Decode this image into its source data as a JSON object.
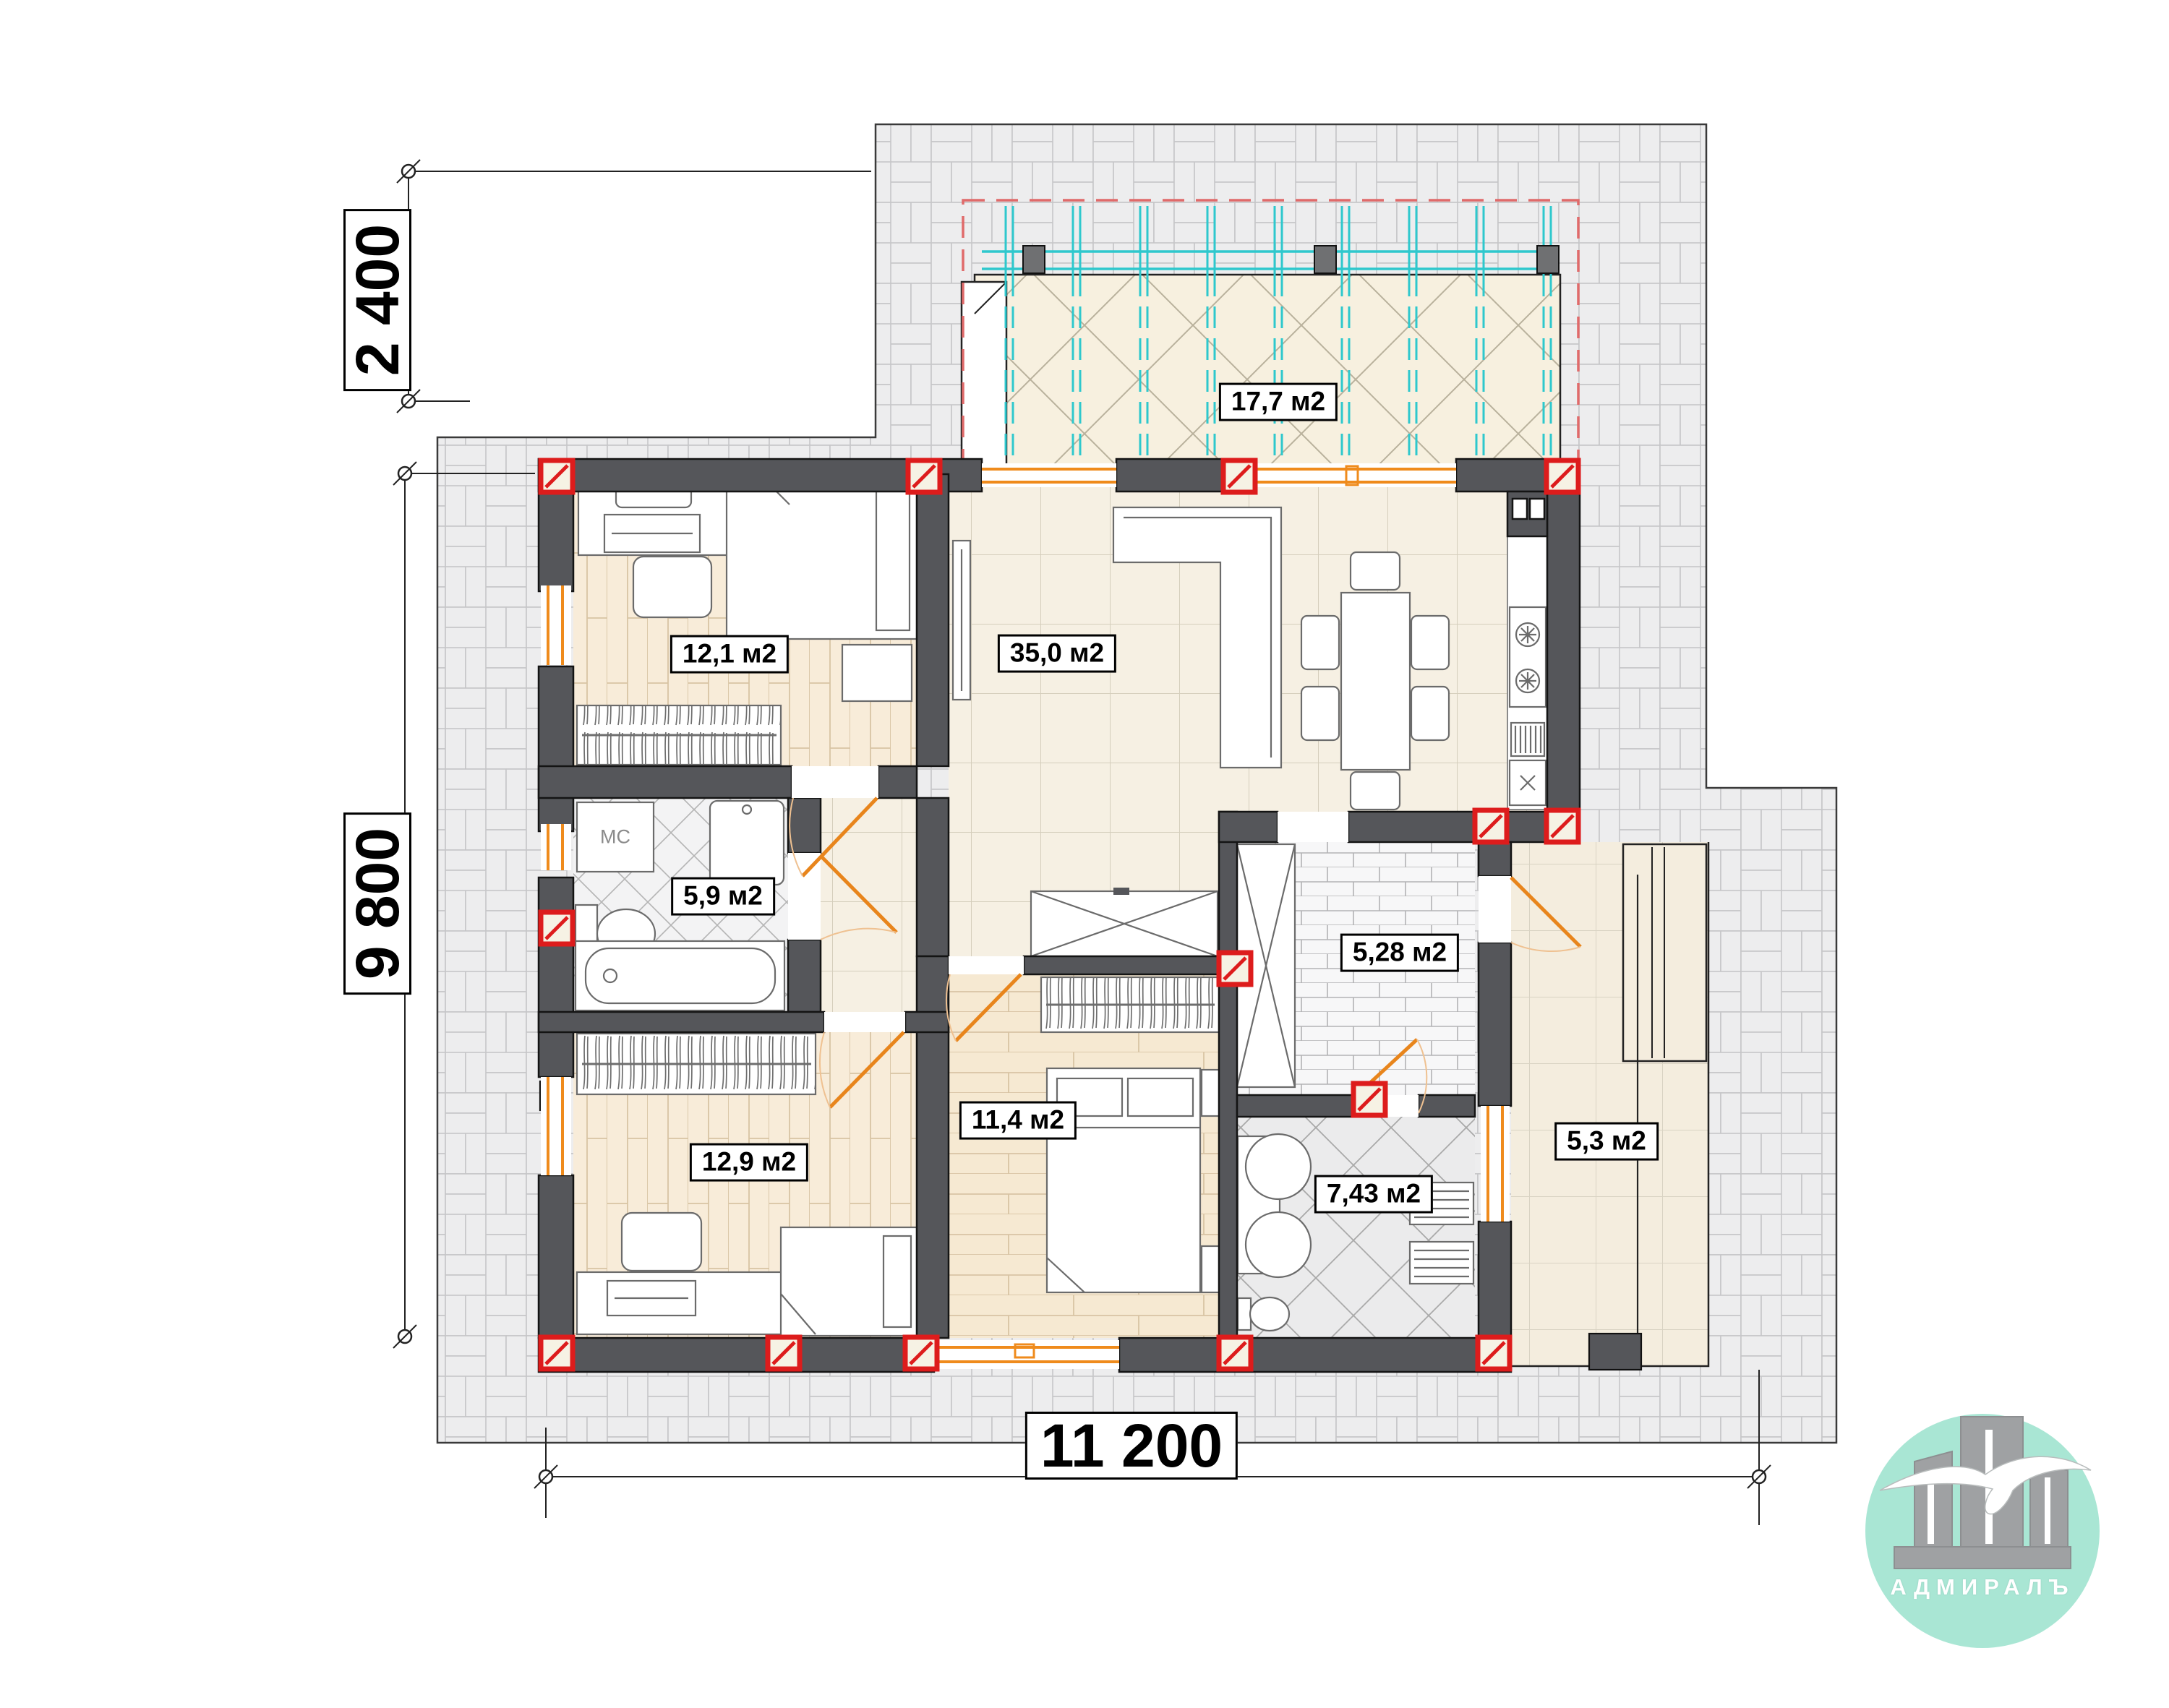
{
  "labels": {
    "terrace": "17,7 м2",
    "living": "35,0 м2",
    "bedroom1": "12,1 м2",
    "bathroom1": "5,9 м2",
    "bedroom2": "12,9 м2",
    "bedroom3": "11,4 м2",
    "pantry": "5,28 м2",
    "bathroom2": "7,43 м2",
    "porch": "5,3 м2",
    "washer": "МС"
  },
  "dimensions": {
    "top_offset": "2 400",
    "left_total": "9 800",
    "bottom_total": "11 200"
  },
  "logo": {
    "brand": "АДМИРАЛЪ"
  },
  "colors": {
    "wall": "#55565a",
    "window_frame": "#ef8b1c",
    "column_marker": "#dd1c1c",
    "pergola_beam": "#2ec8cd",
    "pergola_outline": "#e06a6a",
    "terrace_floor": "#f7f0df",
    "wood_floor": "#f8ecd9",
    "tile_floor": "#f6f0e3",
    "paving": "#efeff0",
    "logo_circle": "#a9e6d4"
  }
}
